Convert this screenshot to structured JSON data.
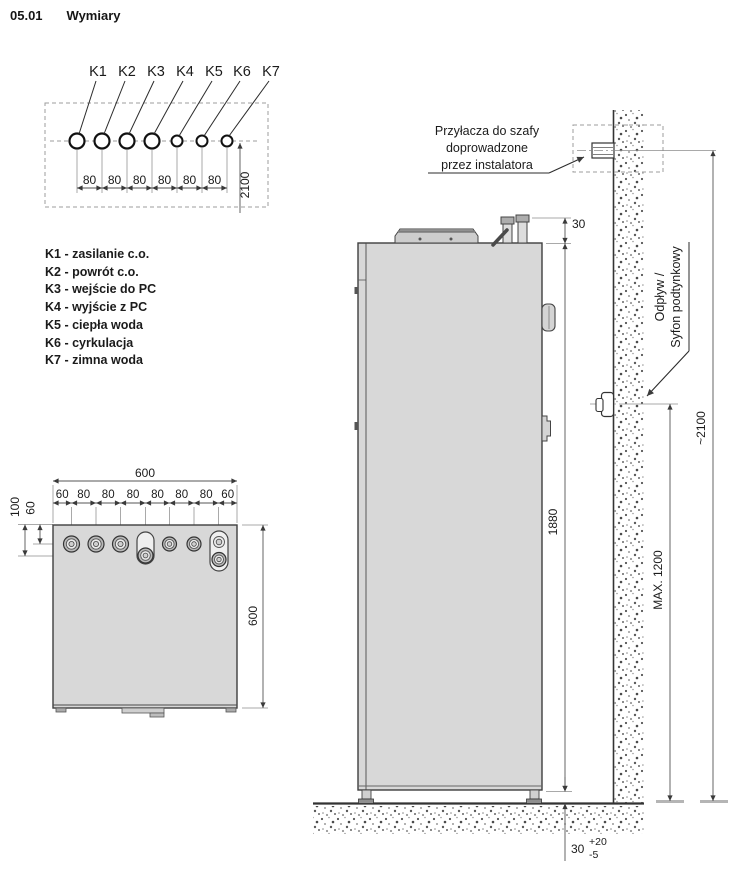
{
  "header": {
    "doc_number": "05.01",
    "title": "Wymiary"
  },
  "ports_diagram": {
    "labels": [
      "K1",
      "K2",
      "K3",
      "K4",
      "K5",
      "K6",
      "K7"
    ],
    "spacing_dims": [
      "80",
      "80",
      "80",
      "80",
      "80",
      "80"
    ],
    "height_dim": "2100"
  },
  "legend": {
    "items": [
      "K1 - zasilanie c.o.",
      "K2 - powrót c.o.",
      "K3 - wejście do PC",
      "K4 - wyjście z PC",
      "K5 - ciepła woda",
      "K6 - cyrkulacja",
      "K7 - zimna woda"
    ]
  },
  "top_view": {
    "width_dim": "600",
    "depth_dim": "600",
    "segment_dims": [
      "60",
      "80",
      "80",
      "80",
      "80",
      "80",
      "80",
      "60"
    ],
    "offset_dim_outer": "100",
    "offset_dim_inner": "60"
  },
  "side_view": {
    "callout_wall_lines": [
      "Przyłacza do szafy",
      "doprowadzone",
      "przez instalatora"
    ],
    "callout_drain_lines": [
      "Odpływ /",
      "Syfon podtynkowy"
    ],
    "dim_valve_height": "30",
    "dim_unit_height": "1880",
    "dim_total_height": "~2100",
    "dim_drain_max": "MAX. 1200",
    "dim_floor_gap": "30",
    "dim_floor_gap_tol_plus": "+20",
    "dim_floor_gap_tol_minus": "-5"
  },
  "colors": {
    "unit_fill": "#d8d8d8",
    "outline": "#3f3f3f",
    "dimension_line": "#555555",
    "text": "#1b1b1b"
  }
}
